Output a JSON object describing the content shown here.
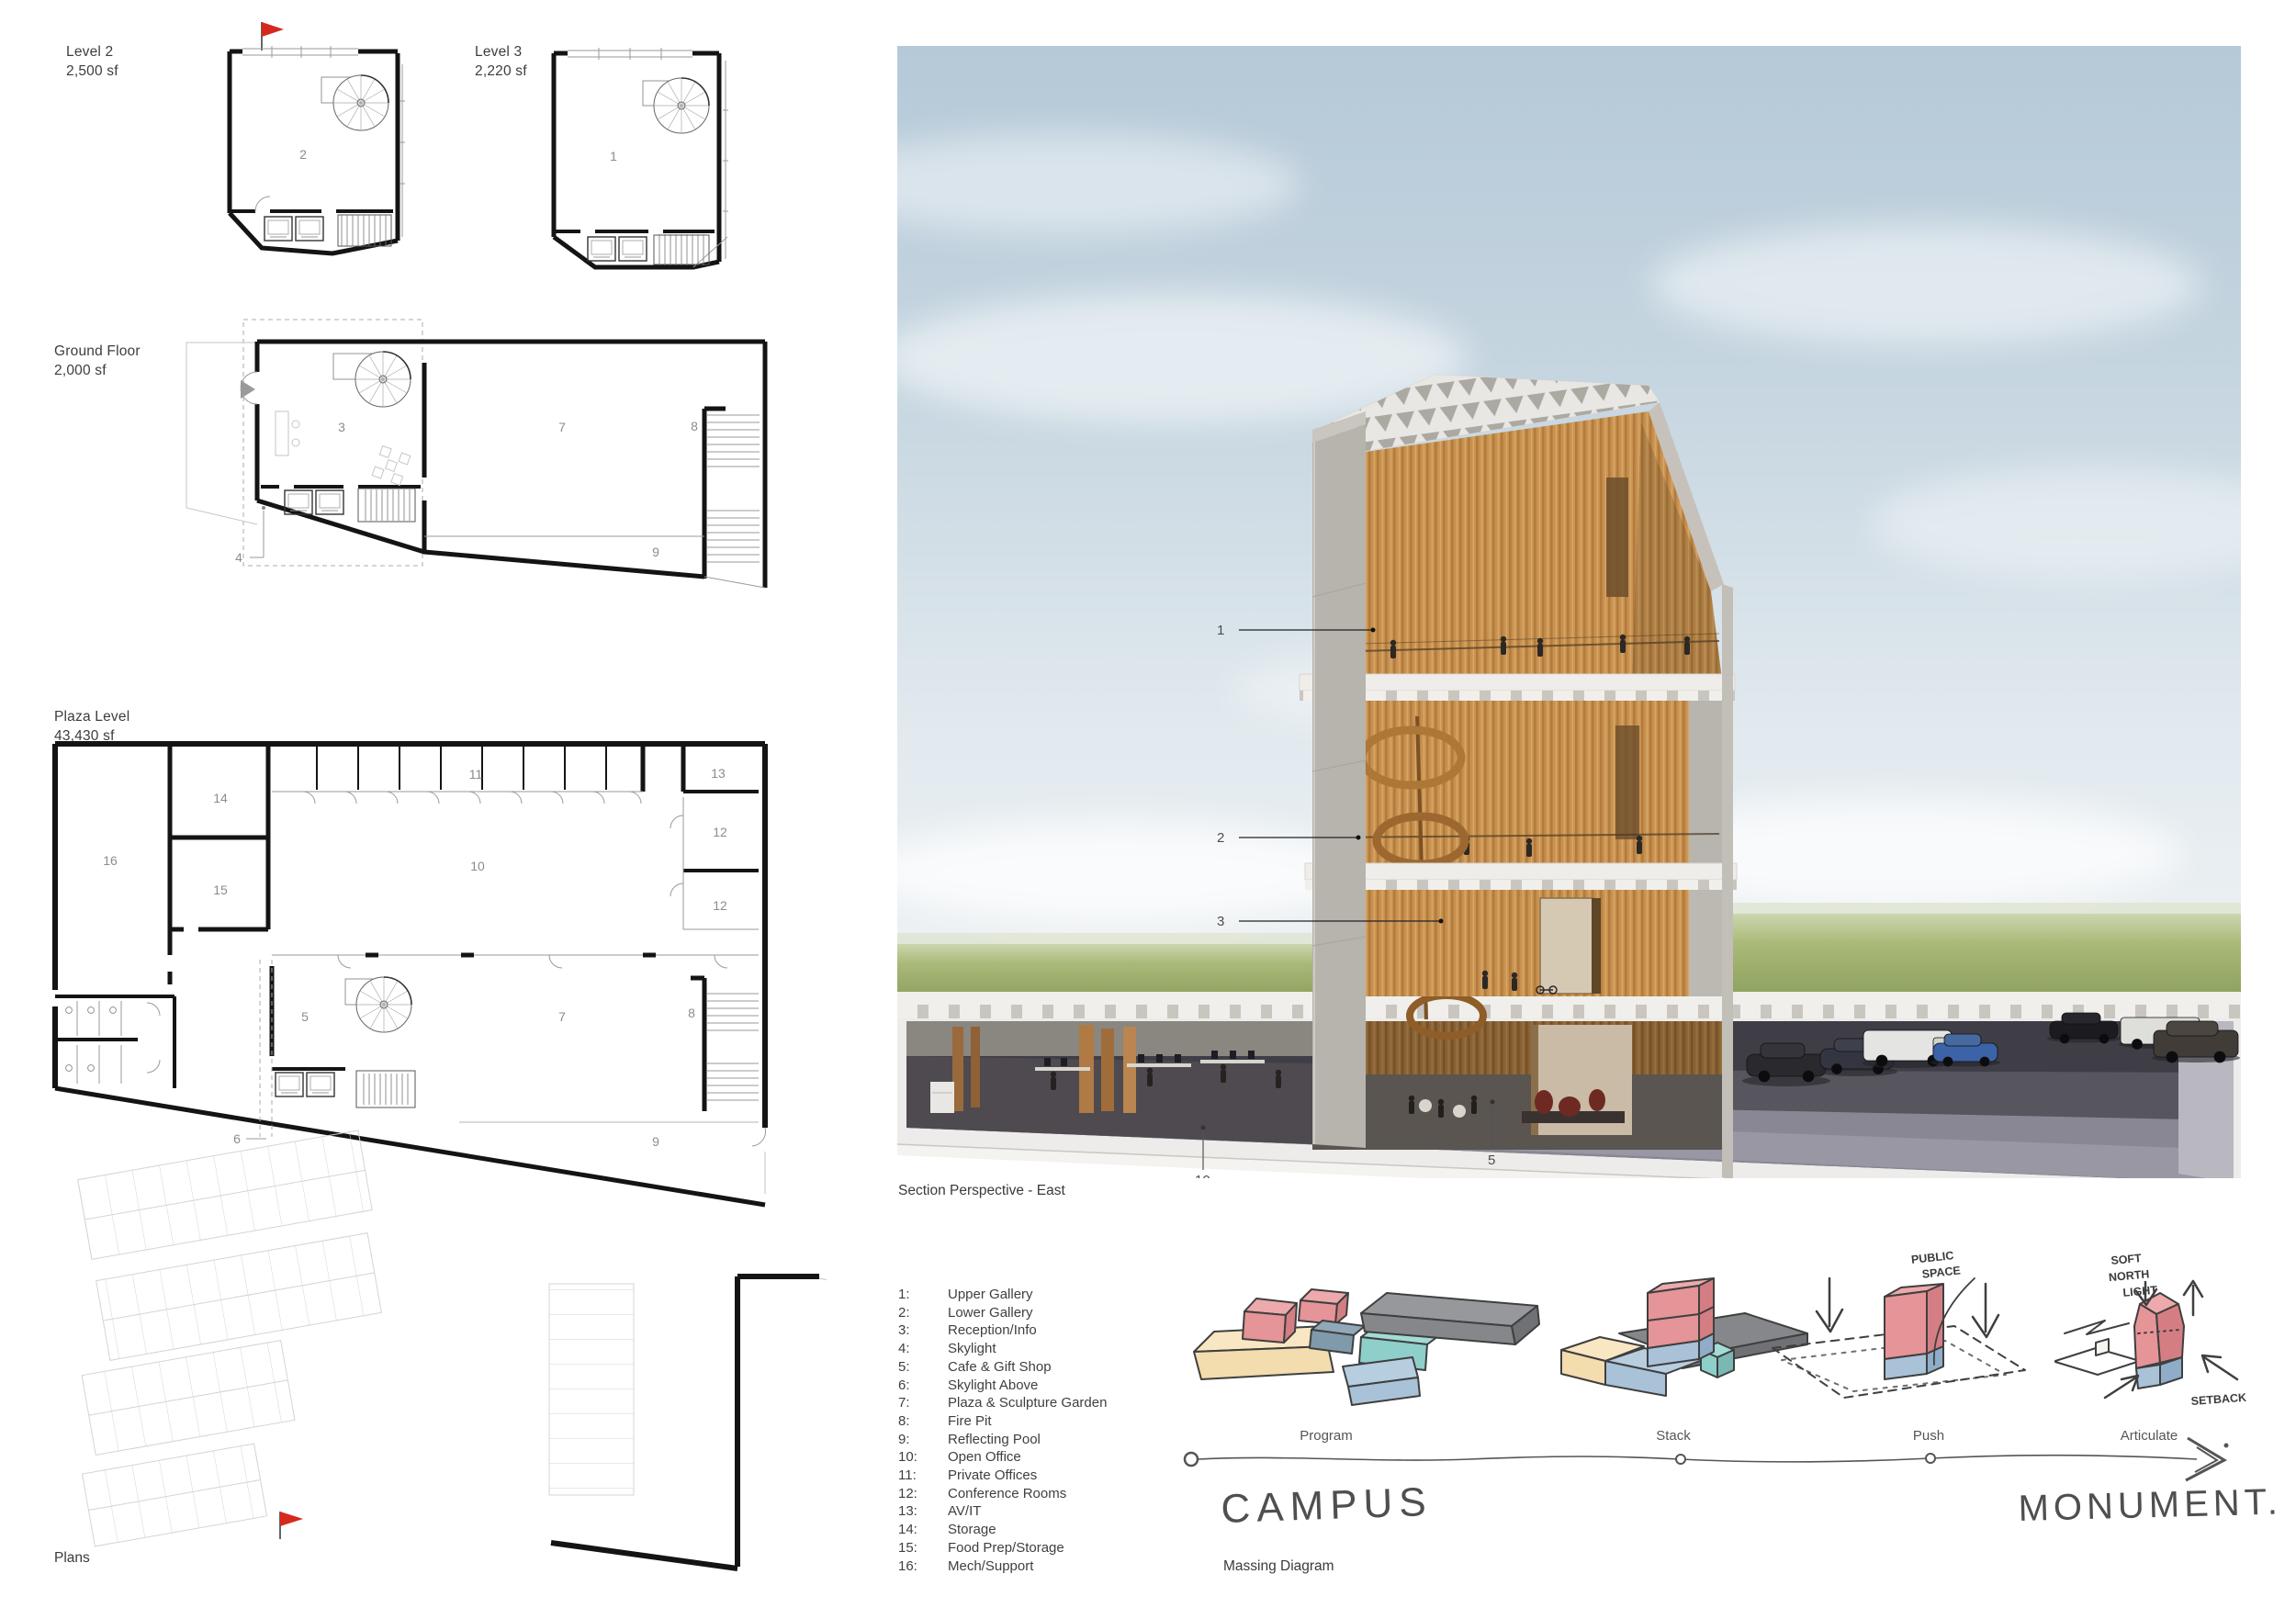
{
  "plans": {
    "caption": "Plans",
    "level2": {
      "title": "Level 2",
      "area": "2,500 sf",
      "room": "2"
    },
    "level3": {
      "title": "Level 3",
      "area": "2,220 sf",
      "room": "1"
    },
    "ground": {
      "title": "Ground Floor",
      "area": "2,000 sf",
      "rooms": {
        "reception": "3",
        "plaza": "7",
        "firepit": "8",
        "pool": "9"
      },
      "callout_skylight": "4"
    },
    "plaza": {
      "title": "Plaza Level",
      "area": "43,430 sf",
      "rooms": {
        "mech": "16",
        "storage": "14",
        "foodprep": "15",
        "private": "11",
        "avit": "13",
        "conf_a": "12",
        "conf_b": "12",
        "open": "10",
        "cafe": "5",
        "plaza": "7",
        "firepit": "8",
        "pool": "9"
      },
      "callout_skylight_above": "6"
    }
  },
  "section": {
    "caption": "Section Perspective - East",
    "callouts": {
      "upper_gallery": "1",
      "lower_gallery": "2",
      "reception": "3",
      "open_office": "10",
      "cafe": "5"
    }
  },
  "legend": {
    "items": [
      {
        "num": "1:",
        "label": "Upper Gallery"
      },
      {
        "num": "2:",
        "label": "Lower Gallery"
      },
      {
        "num": "3:",
        "label": "Reception/Info"
      },
      {
        "num": "4:",
        "label": "Skylight"
      },
      {
        "num": "5:",
        "label": "Cafe & Gift Shop"
      },
      {
        "num": "6:",
        "label": "Skylight Above"
      },
      {
        "num": "7:",
        "label": "Plaza & Sculpture Garden"
      },
      {
        "num": "8:",
        "label": "Fire Pit"
      },
      {
        "num": "9:",
        "label": "Reflecting Pool"
      },
      {
        "num": "10:",
        "label": "Open Office"
      },
      {
        "num": "11:",
        "label": "Private Offices"
      },
      {
        "num": "12:",
        "label": "Conference Rooms"
      },
      {
        "num": "13:",
        "label": "AV/IT"
      },
      {
        "num": "14:",
        "label": "Storage"
      },
      {
        "num": "15:",
        "label": "Food Prep/Storage"
      },
      {
        "num": "16:",
        "label": "Mech/Support"
      }
    ]
  },
  "massing": {
    "caption": "Massing Diagram",
    "stage_labels": [
      "Program",
      "Stack",
      "Push",
      "Articulate"
    ],
    "phase_start": "CAMPUS",
    "phase_end": "MONUMENT.",
    "annotations": {
      "public_1": "PUBLIC",
      "public_2": "SPACE",
      "soft_1": "SOFT",
      "soft_2": "NORTH",
      "soft_3": "LIGHT",
      "setback": "SETBACK"
    }
  },
  "colors": {
    "flag_red": "#d6281e",
    "wood": "#c8914f",
    "massing_pink": "#e59497",
    "massing_tan": "#f3dcae",
    "massing_teal": "#8ecfca",
    "massing_slate": "#7f9aaa",
    "massing_gray": "#85878a",
    "massing_blue": "#a9c2d8",
    "sky": "#c8d7e1",
    "grass": "#a9b977"
  }
}
